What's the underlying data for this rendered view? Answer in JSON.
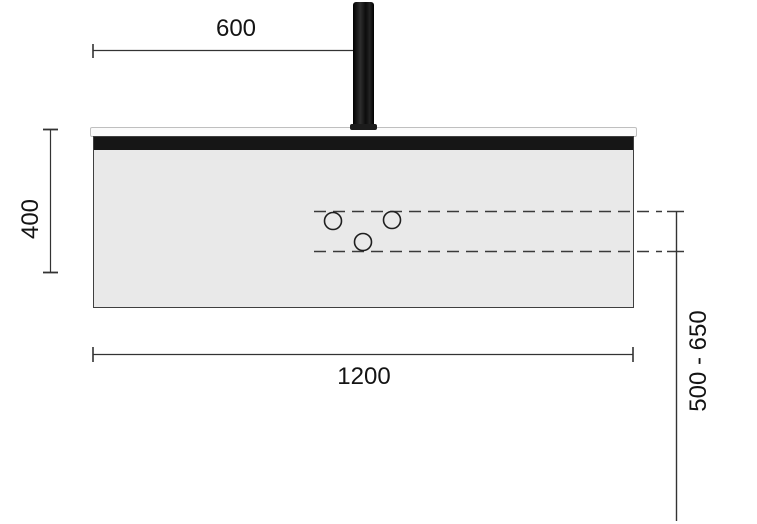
{
  "drawing": {
    "kind": "washbasin console dimension drawing",
    "dimension_labels": {
      "top_offset": "600",
      "left_height": "400",
      "bottom_width": "1200",
      "right_mount_range": "500 - 650"
    },
    "mounting_holes_count": 3,
    "colors": {
      "background": "#ffffff",
      "panel_fill": "#e9e9e9",
      "panel_border": "#3f3f3f",
      "front_rail": "#161616",
      "countertop_strip": "#fbfbfb",
      "faucet": "#111111",
      "dimension_line": "#333333",
      "dashed_line": "#3a3a3a",
      "label_text": "#141414"
    }
  }
}
